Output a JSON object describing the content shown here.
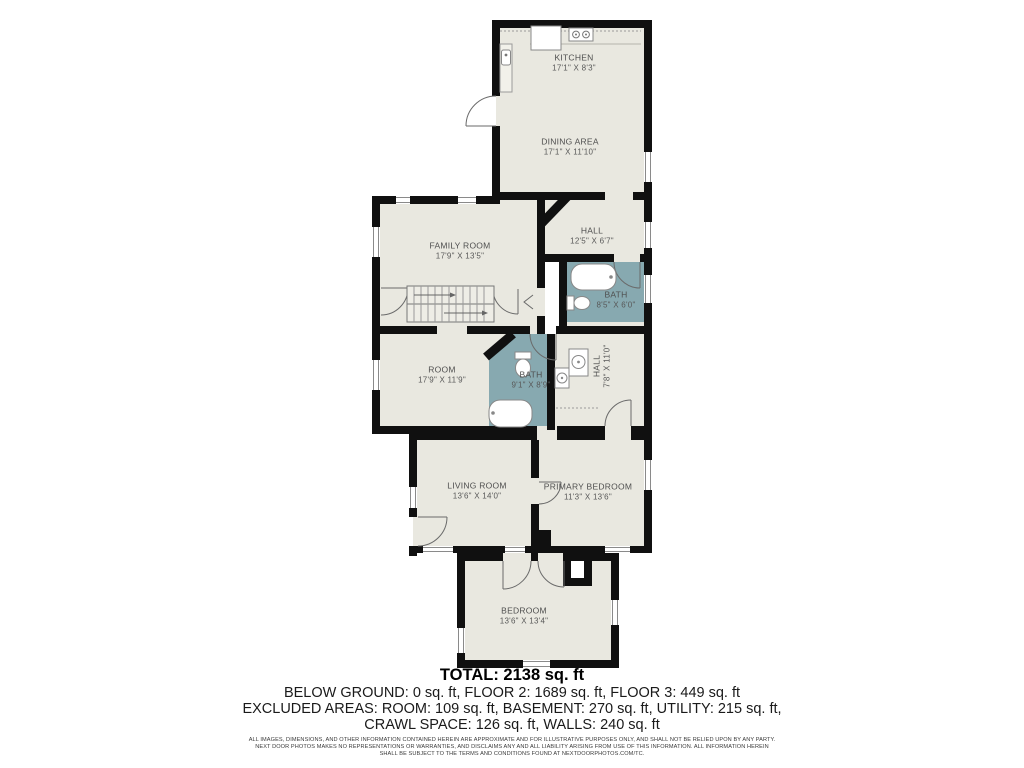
{
  "meta": {
    "type": "floor-plan",
    "provider_note": "NEXT DOOR PHOTOS"
  },
  "colors": {
    "wall": "#101010",
    "room_fill": "#e9e8e0",
    "bath_fill": "#87a9b0",
    "background": "#ffffff",
    "label_text": "#4f4f4f"
  },
  "fixtures": [
    "stove-icon",
    "refrigerator-icon",
    "kitchen-sink-icon",
    "bathtub-icon",
    "toilet-icon",
    "washer-icon",
    "dryer-icon",
    "stairs",
    "door-arc",
    "window"
  ],
  "rooms": [
    {
      "id": "kitchen",
      "name": "KITCHEN",
      "dims": "17'1\" X 8'3\""
    },
    {
      "id": "dining-area",
      "name": "DINING AREA",
      "dims": "17'1\" X 11'10\""
    },
    {
      "id": "hall-upper",
      "name": "HALL",
      "dims": "12'5\" X 6'7\""
    },
    {
      "id": "family-room",
      "name": "FAMILY ROOM",
      "dims": "17'9\" X 13'5\""
    },
    {
      "id": "bath-upper",
      "name": "BATH",
      "dims": "8'5\" X 6'0\""
    },
    {
      "id": "room",
      "name": "ROOM",
      "dims": "17'9\" X 11'9\""
    },
    {
      "id": "bath-lower",
      "name": "BATH",
      "dims": "9'1\" X 8'9\""
    },
    {
      "id": "hall-lower",
      "name": "HALL",
      "dims": "7'8\" X 11'0\""
    },
    {
      "id": "living-room",
      "name": "LIVING ROOM",
      "dims": "13'6\" X 14'0\""
    },
    {
      "id": "primary-bedroom",
      "name": "PRIMARY BEDROOM",
      "dims": "11'3\" X 13'6\""
    },
    {
      "id": "bedroom",
      "name": "BEDROOM",
      "dims": "13'6\" X 13'4\""
    }
  ],
  "summary": {
    "total": "TOTAL: 2138 sq. ft",
    "line1": "BELOW GROUND: 0 sq. ft, FLOOR 2: 1689 sq. ft, FLOOR 3: 449 sq. ft",
    "line2": "EXCLUDED AREAS: ROOM: 109 sq. ft, BASEMENT: 270 sq. ft, UTILITY: 215 sq. ft,",
    "line3": "CRAWL SPACE: 126 sq. ft, WALLS: 240 sq. ft"
  },
  "disclaimer": {
    "line1": "ALL IMAGES, DIMENSIONS, AND OTHER INFORMATION CONTAINED HEREIN ARE APPROXIMATE AND FOR ILLUSTRATIVE PURPOSES ONLY, AND SHALL NOT BE RELIED UPON BY ANY PARTY.",
    "line2": "NEXT DOOR PHOTOS MAKES NO REPRESENTATIONS OR WARRANTIES, AND DISCLAIMS ANY AND ALL LIABILITY ARISING FROM USE OF THIS INFORMATION. ALL INFORMATION HEREIN",
    "line3": "SHALL BE SUBJECT TO THE TERMS AND CONDITIONS FOUND AT NEXTDOORPHOTOS.COM/TC."
  }
}
